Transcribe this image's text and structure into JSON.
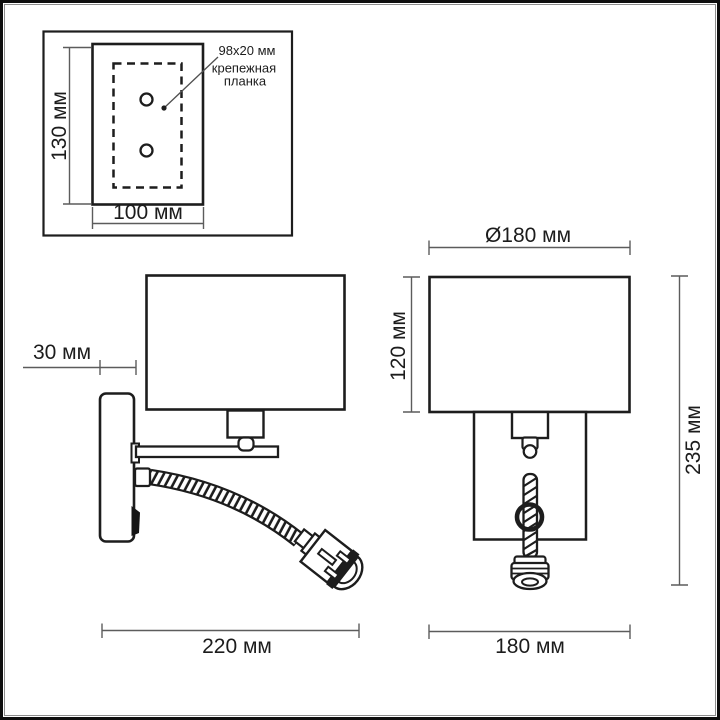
{
  "diagram": {
    "inset": {
      "height_label": "130 мм",
      "width_label": "100 мм",
      "callout": {
        "size": "98x20 мм",
        "word1": "крепежная",
        "word2": "планка"
      }
    },
    "side_view": {
      "depth_label": "30 мм",
      "width_label": "220 мм"
    },
    "front_view": {
      "diameter_label": "Ø180 мм",
      "shade_height_label": "120 мм",
      "total_height_label": "235 мм",
      "width_label": "180 мм"
    },
    "colors": {
      "object_line": "#1d1d1d",
      "dimension_line": "#5c5c5c",
      "text": "#1c1c1c",
      "background": "#ffffff",
      "frame": "#0e0e0e"
    }
  }
}
